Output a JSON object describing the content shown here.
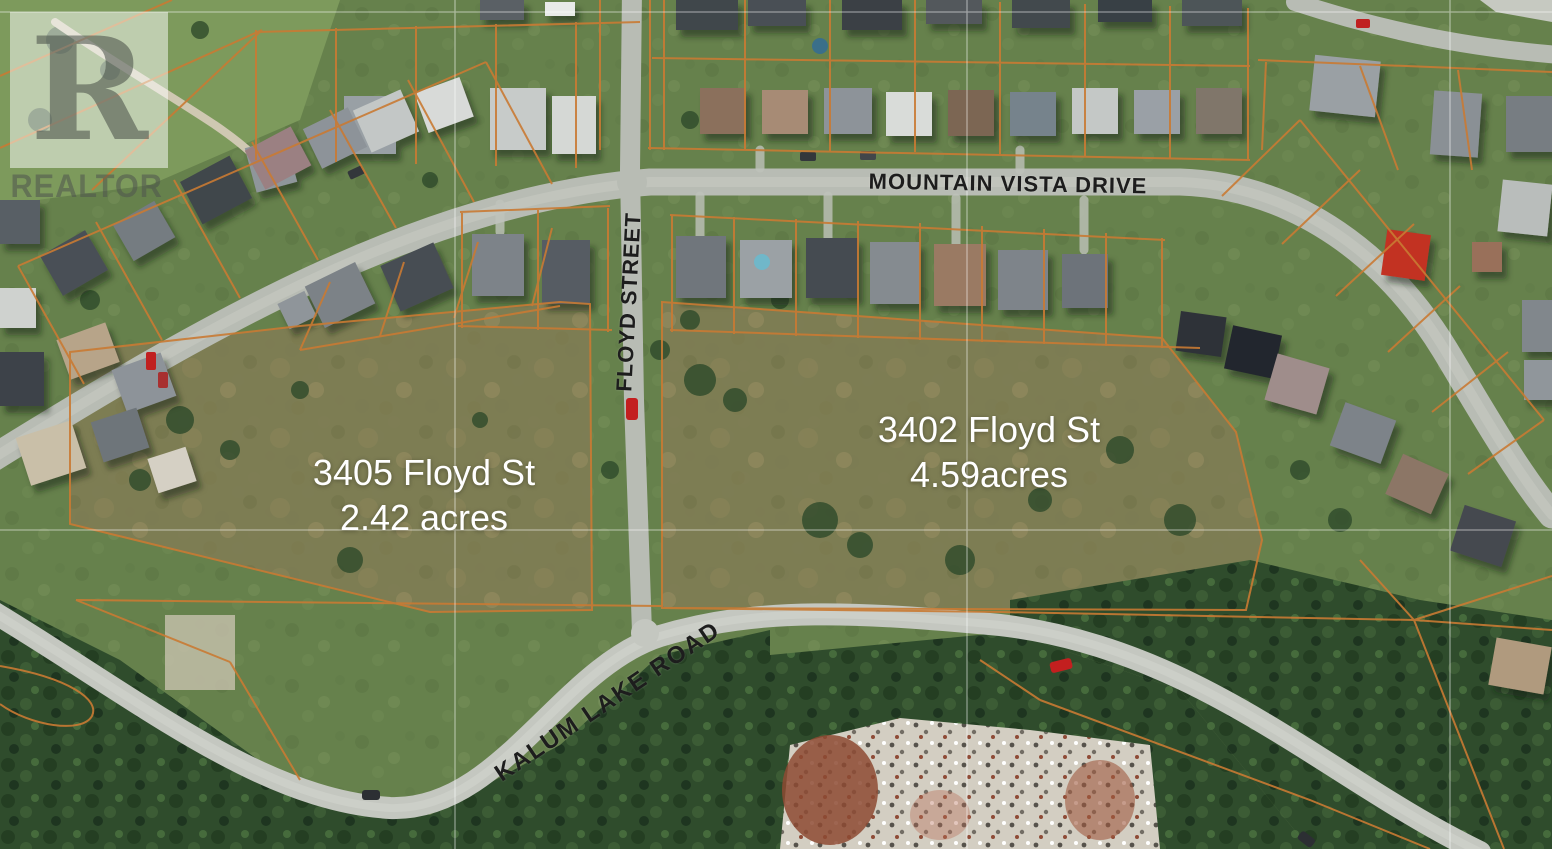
{
  "watermark": {
    "logo_letter": "R",
    "label": "REALTOR"
  },
  "streets": {
    "mountain_vista": "MOUNTAIN VISTA DRIVE",
    "floyd": "FLOYD STREET",
    "kalum": "KALUM LAKE ROAD"
  },
  "parcels": {
    "p3405": {
      "line1": "3405 Floyd St",
      "line2": "2.42 acres"
    },
    "p3402": {
      "line1": "3402 Floyd St",
      "line2": "4.59acres"
    }
  },
  "colors": {
    "parcel_boundary": "#c97a33",
    "street_label": "#1d1d1d",
    "parcel_label": "#ffffff",
    "road": "#b8bcb4",
    "grass": "#66814c",
    "forest": "#2f4c2c",
    "rubble_pile": "#d3cec2",
    "red_roof_house": "#c23222",
    "grid_line": "#ffffff"
  }
}
